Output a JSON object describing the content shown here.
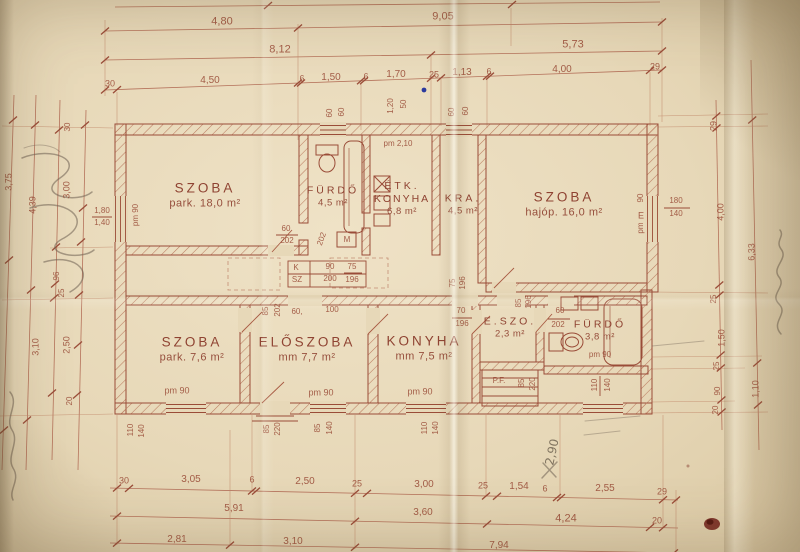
{
  "meta": {
    "description": "Scanned hand-drawn Hungarian house floor plan on aged folded paper",
    "colors": {
      "paper": "#e7d8b8",
      "ink": "#9a4c38",
      "ink_light": "#b5725b",
      "pencil": "#5f5343",
      "stain": "#76281f",
      "blue_dot": "#2a3a9e"
    }
  },
  "rooms": [
    {
      "id": "szoba-18",
      "label": "SZOBA",
      "detail": "park. 18,0 m²",
      "x": 205,
      "y": 196,
      "size": "lg"
    },
    {
      "id": "furdo-45",
      "label": "FÜRDŐ",
      "detail": "4,5 m²",
      "x": 333,
      "y": 197,
      "size": "sm"
    },
    {
      "id": "etk-konyha",
      "label": "ÉTK.",
      "label2": "KONYHA",
      "detail": "6,8 m²",
      "x": 402,
      "y": 199,
      "size": "sm"
    },
    {
      "id": "kra",
      "label": "KRA.",
      "detail": "4,5 m²",
      "x": 463,
      "y": 205,
      "size": "sm"
    },
    {
      "id": "szoba-16",
      "label": "SZOBA",
      "detail": "hajóp. 16,0 m²",
      "x": 564,
      "y": 205,
      "size": "lg"
    },
    {
      "id": "szoba-76",
      "label": "SZOBA",
      "detail": "park. 7,6 m²",
      "x": 192,
      "y": 350,
      "size": "lg"
    },
    {
      "id": "eloszoba",
      "label": "ELŐSZOBA",
      "detail": "mm 7,7 m²",
      "x": 307,
      "y": 350,
      "size": "lg"
    },
    {
      "id": "konyha-75",
      "label": "KONYHA",
      "detail": "mm 7,5 m²",
      "x": 424,
      "y": 349,
      "size": "lg"
    },
    {
      "id": "e-szo",
      "label": "E.SZO.",
      "detail": "2,3 m²",
      "x": 510,
      "y": 328,
      "size": "sm"
    },
    {
      "id": "furdo-38",
      "label": "FÜRDŐ",
      "detail": "3,8 m²",
      "x": 600,
      "y": 331,
      "size": "sm"
    }
  ],
  "dim_labels": [
    {
      "t": "4,80",
      "x": 222,
      "y": 22,
      "s": 11
    },
    {
      "t": "9,05",
      "x": 443,
      "y": 17,
      "s": 11
    },
    {
      "t": "8,12",
      "x": 280,
      "y": 50,
      "s": 11
    },
    {
      "t": "5,73",
      "x": 573,
      "y": 45,
      "s": 11
    },
    {
      "t": "30",
      "x": 110,
      "y": 84,
      "s": 9
    },
    {
      "t": "4,50",
      "x": 210,
      "y": 81,
      "s": 10
    },
    {
      "t": "6",
      "x": 302,
      "y": 79,
      "s": 9
    },
    {
      "t": "1,50",
      "x": 331,
      "y": 78,
      "s": 10
    },
    {
      "t": "6",
      "x": 366,
      "y": 77,
      "s": 9
    },
    {
      "t": "1,70",
      "x": 396,
      "y": 75,
      "s": 10
    },
    {
      "t": "25",
      "x": 434,
      "y": 75,
      "s": 9
    },
    {
      "t": "1,13",
      "x": 462,
      "y": 73,
      "s": 10
    },
    {
      "t": "6",
      "x": 489,
      "y": 72,
      "s": 9
    },
    {
      "t": "4,00",
      "x": 562,
      "y": 70,
      "s": 10
    },
    {
      "t": "29",
      "x": 655,
      "y": 67,
      "s": 9
    },
    {
      "t": "1,20",
      "x": 391,
      "y": 106,
      "r": -90,
      "s": 8
    },
    {
      "t": "50",
      "x": 404,
      "y": 104,
      "r": -90,
      "s": 8
    },
    {
      "t": "60",
      "x": 330,
      "y": 113,
      "r": -90,
      "s": 8
    },
    {
      "t": "60",
      "x": 342,
      "y": 112,
      "r": -90,
      "s": 8
    },
    {
      "t": "60",
      "x": 452,
      "y": 112,
      "r": -90,
      "s": 8
    },
    {
      "t": "60",
      "x": 466,
      "y": 111,
      "r": -90,
      "s": 8
    },
    {
      "t": "pm 2,10",
      "x": 398,
      "y": 144,
      "s": 8
    },
    {
      "t": "3,75",
      "x": 9,
      "y": 182,
      "r": -90,
      "s": 9
    },
    {
      "t": "4,39",
      "x": 33,
      "y": 205,
      "r": -90,
      "s": 9
    },
    {
      "t": "3,00",
      "x": 67,
      "y": 190,
      "r": -90,
      "s": 9
    },
    {
      "t": "1,80",
      "x": 102,
      "y": 211,
      "s": 8
    },
    {
      "t": "1,40",
      "x": 102,
      "y": 223,
      "s": 8
    },
    {
      "t": "pm 90",
      "x": 136,
      "y": 215,
      "r": -90,
      "s": 8
    },
    {
      "t": "30",
      "x": 68,
      "y": 127,
      "r": -90,
      "s": 8
    },
    {
      "t": "96",
      "x": 57,
      "y": 276,
      "r": -90,
      "s": 8
    },
    {
      "t": "25",
      "x": 62,
      "y": 293,
      "r": -90,
      "s": 8
    },
    {
      "t": "3,10",
      "x": 36,
      "y": 347,
      "r": -90,
      "s": 9
    },
    {
      "t": "2,50",
      "x": 67,
      "y": 345,
      "r": -90,
      "s": 9
    },
    {
      "t": "20",
      "x": 70,
      "y": 401,
      "r": -90,
      "s": 8
    },
    {
      "t": "29",
      "x": 714,
      "y": 126,
      "r": -90,
      "s": 9
    },
    {
      "t": "4,00",
      "x": 721,
      "y": 212,
      "r": -90,
      "s": 9
    },
    {
      "t": "6,33",
      "x": 752,
      "y": 252,
      "r": -90,
      "s": 9
    },
    {
      "t": "25",
      "x": 714,
      "y": 299,
      "r": -90,
      "s": 8
    },
    {
      "t": "1,50",
      "x": 722,
      "y": 338,
      "r": -90,
      "s": 9
    },
    {
      "t": "25",
      "x": 717,
      "y": 366,
      "r": -90,
      "s": 8
    },
    {
      "t": "90",
      "x": 718,
      "y": 391,
      "r": -90,
      "s": 8
    },
    {
      "t": "20",
      "x": 716,
      "y": 410,
      "r": -90,
      "s": 8
    },
    {
      "t": "1,10",
      "x": 756,
      "y": 389,
      "r": -90,
      "s": 9
    },
    {
      "t": "90",
      "x": 641,
      "y": 198,
      "r": -90,
      "s": 8
    },
    {
      "t": "E",
      "x": 641,
      "y": 216,
      "s": 9
    },
    {
      "t": "pm",
      "x": 641,
      "y": 228,
      "r": -90,
      "s": 8
    },
    {
      "t": "180",
      "x": 676,
      "y": 201,
      "s": 8
    },
    {
      "t": "140",
      "x": 676,
      "y": 214,
      "s": 8
    },
    {
      "t": "60",
      "x": 286,
      "y": 229,
      "s": 8
    },
    {
      "t": "202",
      "x": 287,
      "y": 241,
      "s": 8
    },
    {
      "t": "202",
      "x": 322,
      "y": 239,
      "r": -70,
      "s": 8
    },
    {
      "t": "M",
      "x": 347,
      "y": 240,
      "s": 8
    },
    {
      "t": "K",
      "x": 296,
      "y": 268,
      "s": 8
    },
    {
      "t": "90",
      "x": 330,
      "y": 267,
      "s": 8
    },
    {
      "t": "SZ",
      "x": 297,
      "y": 280,
      "s": 8
    },
    {
      "t": "200",
      "x": 330,
      "y": 279,
      "s": 8
    },
    {
      "t": "75",
      "x": 352,
      "y": 267,
      "s": 8
    },
    {
      "t": "196",
      "x": 352,
      "y": 280,
      "s": 8
    },
    {
      "t": "75",
      "x": 453,
      "y": 283,
      "r": -90,
      "s": 8
    },
    {
      "t": "196",
      "x": 463,
      "y": 283,
      "r": -90,
      "s": 8
    },
    {
      "t": "85",
      "x": 266,
      "y": 311,
      "r": -90,
      "s": 8
    },
    {
      "t": "202",
      "x": 278,
      "y": 310,
      "r": -90,
      "s": 8
    },
    {
      "t": "60,",
      "x": 297,
      "y": 312,
      "s": 8
    },
    {
      "t": "100",
      "x": 332,
      "y": 310,
      "s": 8
    },
    {
      "t": "70",
      "x": 461,
      "y": 311,
      "s": 8
    },
    {
      "t": "196",
      "x": 462,
      "y": 324,
      "s": 8
    },
    {
      "t": "85",
      "x": 519,
      "y": 303,
      "r": -90,
      "s": 8
    },
    {
      "t": "196",
      "x": 529,
      "y": 302,
      "r": -90,
      "s": 8
    },
    {
      "t": "60",
      "x": 560,
      "y": 311,
      "s": 8
    },
    {
      "t": "202",
      "x": 558,
      "y": 325,
      "s": 8
    },
    {
      "t": "P.F.",
      "x": 499,
      "y": 381,
      "s": 8
    },
    {
      "t": "85",
      "x": 522,
      "y": 383,
      "r": -90,
      "s": 8
    },
    {
      "t": "220",
      "x": 533,
      "y": 384,
      "r": -90,
      "s": 8
    },
    {
      "t": "110",
      "x": 595,
      "y": 385,
      "r": -90,
      "s": 8
    },
    {
      "t": "140",
      "x": 608,
      "y": 385,
      "r": -90,
      "s": 8
    },
    {
      "t": "pm 90",
      "x": 600,
      "y": 355,
      "s": 8
    },
    {
      "t": "pm 90",
      "x": 177,
      "y": 391,
      "s": 9
    },
    {
      "t": "pm 90",
      "x": 321,
      "y": 393,
      "s": 9
    },
    {
      "t": "pm 90",
      "x": 420,
      "y": 392,
      "s": 9
    },
    {
      "t": "110",
      "x": 131,
      "y": 430,
      "r": -90,
      "s": 8
    },
    {
      "t": "140",
      "x": 142,
      "y": 431,
      "r": -90,
      "s": 8
    },
    {
      "t": "85",
      "x": 267,
      "y": 429,
      "r": -90,
      "s": 8
    },
    {
      "t": "220",
      "x": 278,
      "y": 429,
      "r": -90,
      "s": 8
    },
    {
      "t": "85",
      "x": 318,
      "y": 428,
      "r": -90,
      "s": 8
    },
    {
      "t": "140",
      "x": 330,
      "y": 428,
      "r": -90,
      "s": 8
    },
    {
      "t": "110",
      "x": 425,
      "y": 428,
      "r": -90,
      "s": 8
    },
    {
      "t": "140",
      "x": 436,
      "y": 428,
      "r": -90,
      "s": 8
    },
    {
      "t": "30",
      "x": 124,
      "y": 481,
      "s": 9
    },
    {
      "t": "3,05",
      "x": 191,
      "y": 480,
      "s": 10
    },
    {
      "t": "6",
      "x": 252,
      "y": 480,
      "s": 9
    },
    {
      "t": "2,50",
      "x": 305,
      "y": 482,
      "s": 10
    },
    {
      "t": "25",
      "x": 357,
      "y": 484,
      "s": 9
    },
    {
      "t": "3,00",
      "x": 424,
      "y": 485,
      "s": 10
    },
    {
      "t": "25",
      "x": 483,
      "y": 486,
      "s": 9
    },
    {
      "t": "1,54",
      "x": 519,
      "y": 487,
      "s": 10
    },
    {
      "t": "6",
      "x": 545,
      "y": 489,
      "s": 9
    },
    {
      "t": "2,55",
      "x": 605,
      "y": 489,
      "s": 10
    },
    {
      "t": "29",
      "x": 662,
      "y": 492,
      "s": 9
    },
    {
      "t": "5,91",
      "x": 234,
      "y": 509,
      "s": 10
    },
    {
      "t": "3,60",
      "x": 423,
      "y": 513,
      "s": 10
    },
    {
      "t": "4,24",
      "x": 566,
      "y": 519,
      "s": 11
    },
    {
      "t": "20",
      "x": 657,
      "y": 521,
      "s": 9
    },
    {
      "t": "2,81",
      "x": 177,
      "y": 540,
      "s": 10
    },
    {
      "t": "3,10",
      "x": 293,
      "y": 542,
      "s": 10
    },
    {
      "t": "7,94",
      "x": 499,
      "y": 546,
      "s": 10
    }
  ],
  "annotations": [
    {
      "t": "2,90",
      "x": 552,
      "y": 452,
      "r": -78,
      "s": 12,
      "p": 1
    }
  ]
}
